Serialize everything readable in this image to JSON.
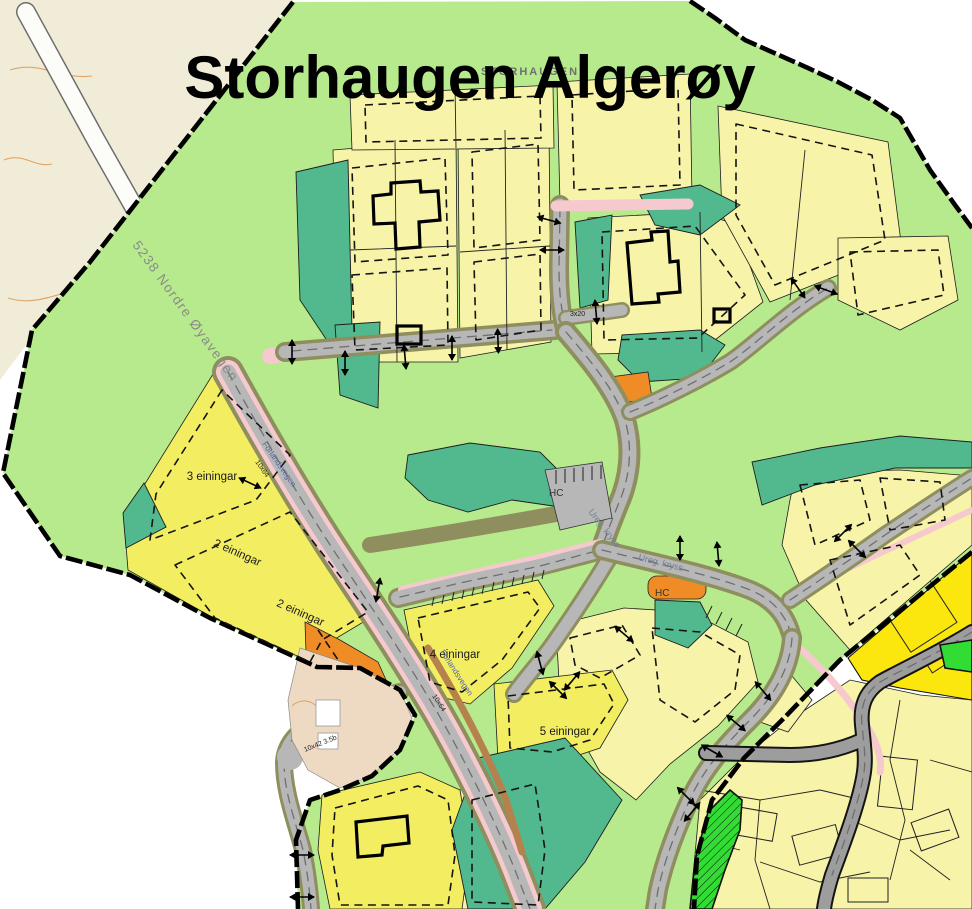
{
  "title": "Storhaugen Algerøy",
  "ghost_label": "STORHAUGEN",
  "external_road": {
    "label": "5238 Nordre Øyavegen"
  },
  "internal_roads": {
    "name_a": "Forlandsvegen",
    "name_b": "Forlandsvegen"
  },
  "dimensions": {
    "d1": "10x64",
    "d2": "10x64",
    "d3": "10x42 3.5b",
    "d4": "3x20"
  },
  "units": {
    "u3": "3 einingar",
    "u2a": "2 einingar",
    "u2b": "2 einingar",
    "u4": "4 einingar",
    "u5": "5 einingar"
  },
  "parking": {
    "hc1": "HC",
    "hc2": "HC"
  },
  "junctions": {
    "j1": "Ureg. kryss",
    "j2": "Ureg. kryss"
  },
  "colors": {
    "beige": "#f1ecd8",
    "pocket": "#eedac3",
    "plan_green": "#b7ea8c",
    "teal": "#52b98e",
    "pale_yellow": "#f7f3a8",
    "bright_yellow": "#f3ed62",
    "adj_yellow": "#fbe70d",
    "bright_green": "#33dc35",
    "khaki": "#8e8e5f",
    "road_gray": "#b7b7b7",
    "road_dash": "#6f6f6f",
    "adj_road": "#9d9d9d",
    "pink": "#f6c9ce",
    "brown": "#b5824e",
    "orange": "#f08c26",
    "contour": "#dfa566",
    "blue_text": "#56659a",
    "gray_text": "#8a8a8a"
  }
}
